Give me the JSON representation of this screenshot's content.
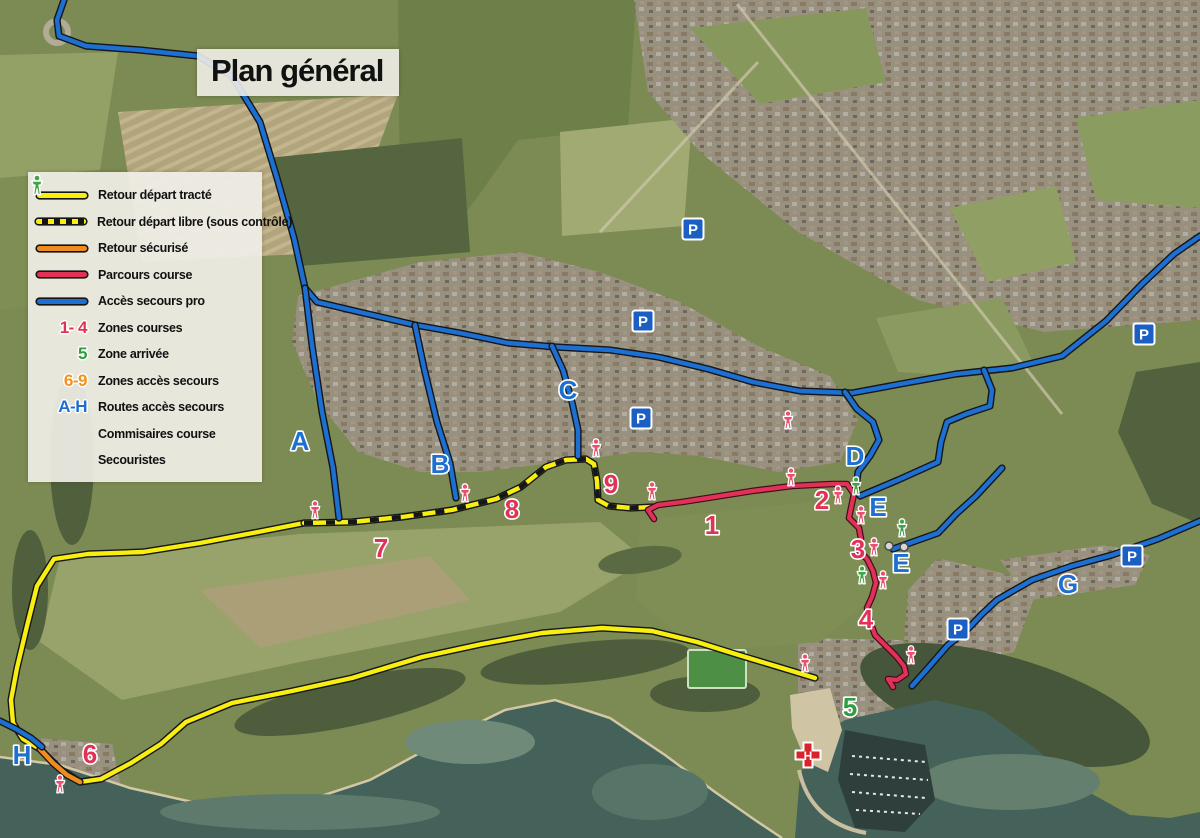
{
  "title": "Plan général",
  "legend": {
    "items": [
      {
        "type": "line",
        "swatch": "yellow",
        "label": "Retour départ tracté"
      },
      {
        "type": "line",
        "swatch": "yellow-dashed",
        "label": "Retour départ libre (sous contrôle)"
      },
      {
        "type": "line",
        "swatch": "orange",
        "label": "Retour sécurisé"
      },
      {
        "type": "line",
        "swatch": "red",
        "label": "Parcours course"
      },
      {
        "type": "line",
        "swatch": "blue",
        "label": "Accès secours pro"
      },
      {
        "type": "symbol",
        "symbol": "1- 4",
        "color": "#e23157",
        "label": "Zones courses"
      },
      {
        "type": "symbol",
        "symbol": "5",
        "color": "#2f9e41",
        "label": "Zone arrivée"
      },
      {
        "type": "symbol",
        "symbol": "6-9",
        "color": "#f5921e",
        "label": "Zones accès secours"
      },
      {
        "type": "symbol",
        "symbol": "A-H",
        "color": "#1c6fd2",
        "label": "Routes accès secours"
      },
      {
        "type": "icon",
        "icon": "person-pink",
        "color": "#e9506f",
        "label": "Commisaires course"
      },
      {
        "type": "icon",
        "icon": "person-green",
        "color": "#3fa548",
        "label": "Secouristes"
      }
    ]
  },
  "map": {
    "colors": {
      "blue": "#1d6fd1",
      "yellow": "#f8ee10",
      "orange": "#f08c1e",
      "red": "#e23157",
      "zone_green": "#2f9e41",
      "commissaire": "#e9506f",
      "secouriste": "#3fa548",
      "parking_bg": "#1b5fc4",
      "helipad": "#d8232a"
    },
    "routes": [
      {
        "name": "retour-depart-tracte",
        "style": "yellow",
        "points": [
          [
            304,
            523
          ],
          [
            258,
            532
          ],
          [
            200,
            543
          ],
          [
            143,
            552
          ],
          [
            88,
            554
          ],
          [
            54,
            559
          ],
          [
            37,
            586
          ],
          [
            27,
            626
          ],
          [
            17,
            668
          ],
          [
            11,
            700
          ],
          [
            13,
            723
          ],
          [
            23,
            739
          ],
          [
            40,
            749
          ],
          [
            60,
            769
          ],
          [
            80,
            782
          ],
          [
            101,
            779
          ],
          [
            131,
            763
          ],
          [
            161,
            744
          ],
          [
            186,
            722
          ],
          [
            232,
            703
          ],
          [
            292,
            691
          ],
          [
            352,
            678
          ],
          [
            422,
            657
          ],
          [
            482,
            644
          ],
          [
            542,
            633
          ],
          [
            602,
            628
          ],
          [
            652,
            631
          ],
          [
            697,
            642
          ],
          [
            742,
            656
          ],
          [
            782,
            668
          ],
          [
            815,
            678
          ]
        ]
      },
      {
        "name": "retour-depart-libre",
        "style": "yellow-dashed",
        "points": [
          [
            304,
            523
          ],
          [
            352,
            522
          ],
          [
            402,
            517
          ],
          [
            452,
            510
          ],
          [
            496,
            499
          ],
          [
            521,
            487
          ],
          [
            546,
            467
          ],
          [
            566,
            460
          ],
          [
            586,
            459
          ],
          [
            594,
            464
          ],
          [
            597,
            481
          ],
          [
            598,
            500
          ],
          [
            609,
            506
          ],
          [
            631,
            508
          ],
          [
            653,
            507
          ]
        ]
      },
      {
        "name": "retour-securise",
        "style": "orange",
        "points": [
          [
            40,
            749
          ],
          [
            53,
            763
          ],
          [
            67,
            775
          ],
          [
            80,
            782
          ]
        ]
      },
      {
        "name": "acces-secours-main",
        "style": "blue",
        "points": [
          [
            64,
            0
          ],
          [
            57,
            20
          ],
          [
            59,
            36
          ],
          [
            86,
            46
          ],
          [
            140,
            50
          ],
          [
            198,
            56
          ],
          [
            232,
            76
          ],
          [
            260,
            122
          ],
          [
            277,
            178
          ],
          [
            294,
            238
          ],
          [
            305,
            288
          ],
          [
            317,
            302
          ],
          [
            355,
            311
          ],
          [
            415,
            325
          ],
          [
            460,
            333
          ],
          [
            508,
            343
          ],
          [
            556,
            347
          ],
          [
            610,
            350
          ],
          [
            658,
            357
          ],
          [
            708,
            369
          ],
          [
            753,
            382
          ],
          [
            800,
            391
          ],
          [
            852,
            393
          ],
          [
            906,
            383
          ],
          [
            956,
            374
          ],
          [
            1012,
            368
          ],
          [
            1062,
            356
          ],
          [
            1106,
            321
          ],
          [
            1142,
            284
          ],
          [
            1174,
            254
          ],
          [
            1200,
            236
          ]
        ]
      },
      {
        "name": "route-a",
        "style": "blue",
        "points": [
          [
            305,
            288
          ],
          [
            312,
            345
          ],
          [
            322,
            412
          ],
          [
            333,
            468
          ],
          [
            339,
            518
          ]
        ]
      },
      {
        "name": "route-b",
        "style": "blue",
        "points": [
          [
            415,
            325
          ],
          [
            424,
            368
          ],
          [
            437,
            422
          ],
          [
            450,
            463
          ],
          [
            456,
            498
          ]
        ]
      },
      {
        "name": "route-c",
        "style": "blue",
        "points": [
          [
            552,
            346
          ],
          [
            563,
            370
          ],
          [
            572,
            402
          ],
          [
            578,
            430
          ],
          [
            578,
            456
          ]
        ]
      },
      {
        "name": "route-d",
        "style": "blue",
        "points": [
          [
            845,
            392
          ],
          [
            857,
            409
          ],
          [
            873,
            422
          ],
          [
            879,
            440
          ],
          [
            870,
            456
          ],
          [
            858,
            472
          ],
          [
            856,
            489
          ]
        ]
      },
      {
        "name": "route-e-upper",
        "style": "blue",
        "points": [
          [
            984,
            370
          ],
          [
            992,
            390
          ],
          [
            990,
            406
          ],
          [
            966,
            414
          ],
          [
            947,
            422
          ],
          [
            941,
            442
          ],
          [
            938,
            462
          ],
          [
            898,
            480
          ],
          [
            860,
            496
          ]
        ]
      },
      {
        "name": "route-e-lower",
        "style": "blue",
        "points": [
          [
            1002,
            468
          ],
          [
            976,
            496
          ],
          [
            956,
            514
          ],
          [
            938,
            533
          ],
          [
            893,
            549
          ]
        ]
      },
      {
        "name": "route-g",
        "style": "blue",
        "points": [
          [
            912,
            686
          ],
          [
            928,
            668
          ],
          [
            948,
            645
          ],
          [
            965,
            632
          ],
          [
            982,
            614
          ],
          [
            997,
            600
          ],
          [
            1032,
            580
          ],
          [
            1072,
            566
          ],
          [
            1112,
            555
          ],
          [
            1158,
            539
          ],
          [
            1200,
            521
          ]
        ]
      },
      {
        "name": "route-h",
        "style": "blue",
        "points": [
          [
            0,
            721
          ],
          [
            16,
            729
          ],
          [
            31,
            738
          ],
          [
            42,
            747
          ]
        ]
      },
      {
        "name": "parcours-course",
        "style": "red",
        "points": [
          [
            654,
            519
          ],
          [
            648,
            510
          ],
          [
            658,
            505
          ],
          [
            682,
            502
          ],
          [
            714,
            497
          ],
          [
            752,
            491
          ],
          [
            792,
            486
          ],
          [
            832,
            484
          ],
          [
            847,
            484
          ],
          [
            854,
            494
          ],
          [
            851,
            508
          ],
          [
            849,
            518
          ],
          [
            859,
            528
          ],
          [
            861,
            539
          ],
          [
            857,
            549
          ],
          [
            867,
            559
          ],
          [
            873,
            571
          ],
          [
            876,
            583
          ],
          [
            872,
            597
          ],
          [
            867,
            608
          ],
          [
            870,
            621
          ],
          [
            875,
            635
          ],
          [
            886,
            646
          ],
          [
            896,
            656
          ],
          [
            904,
            666
          ],
          [
            906,
            674
          ],
          [
            897,
            680
          ],
          [
            888,
            679
          ],
          [
            893,
            687
          ]
        ]
      }
    ],
    "letters": [
      {
        "t": "A",
        "x": 300,
        "y": 441
      },
      {
        "t": "B",
        "x": 440,
        "y": 464
      },
      {
        "t": "C",
        "x": 568,
        "y": 390
      },
      {
        "t": "D",
        "x": 855,
        "y": 456
      },
      {
        "t": "E",
        "x": 878,
        "y": 507
      },
      {
        "t": "E",
        "x": 901,
        "y": 563
      },
      {
        "t": "G",
        "x": 1068,
        "y": 584
      },
      {
        "t": "H",
        "x": 22,
        "y": 755
      }
    ],
    "numbers": [
      {
        "t": "1",
        "x": 712,
        "y": 525,
        "color": "#e23157"
      },
      {
        "t": "2",
        "x": 822,
        "y": 500,
        "color": "#e23157"
      },
      {
        "t": "3",
        "x": 858,
        "y": 549,
        "color": "#e23157"
      },
      {
        "t": "4",
        "x": 866,
        "y": 619,
        "color": "#e23157"
      },
      {
        "t": "5",
        "x": 850,
        "y": 707,
        "color": "#2f9e41"
      },
      {
        "t": "6",
        "x": 90,
        "y": 754,
        "color": "#e23157"
      },
      {
        "t": "7",
        "x": 381,
        "y": 548,
        "color": "#e23157"
      },
      {
        "t": "8",
        "x": 512,
        "y": 509,
        "color": "#e23157"
      },
      {
        "t": "9",
        "x": 611,
        "y": 484,
        "color": "#e23157"
      }
    ],
    "parking_label": "P",
    "parking": [
      {
        "x": 693,
        "y": 229
      },
      {
        "x": 643,
        "y": 321
      },
      {
        "x": 641,
        "y": 418
      },
      {
        "x": 1144,
        "y": 334
      },
      {
        "x": 1132,
        "y": 556
      },
      {
        "x": 958,
        "y": 629
      }
    ],
    "commissaires": [
      {
        "x": 315,
        "y": 511
      },
      {
        "x": 465,
        "y": 494
      },
      {
        "x": 596,
        "y": 449
      },
      {
        "x": 652,
        "y": 492
      },
      {
        "x": 788,
        "y": 421
      },
      {
        "x": 791,
        "y": 478
      },
      {
        "x": 838,
        "y": 496
      },
      {
        "x": 861,
        "y": 516
      },
      {
        "x": 874,
        "y": 548
      },
      {
        "x": 883,
        "y": 581
      },
      {
        "x": 911,
        "y": 656
      },
      {
        "x": 805,
        "y": 664
      },
      {
        "x": 60,
        "y": 785
      }
    ],
    "secouristes": [
      {
        "x": 856,
        "y": 487
      },
      {
        "x": 902,
        "y": 529
      },
      {
        "x": 862,
        "y": 576
      }
    ],
    "helipad": {
      "x": 808,
      "y": 755,
      "label": "H"
    },
    "gate_dots": [
      [
        889,
        546
      ],
      [
        904,
        547
      ]
    ]
  }
}
